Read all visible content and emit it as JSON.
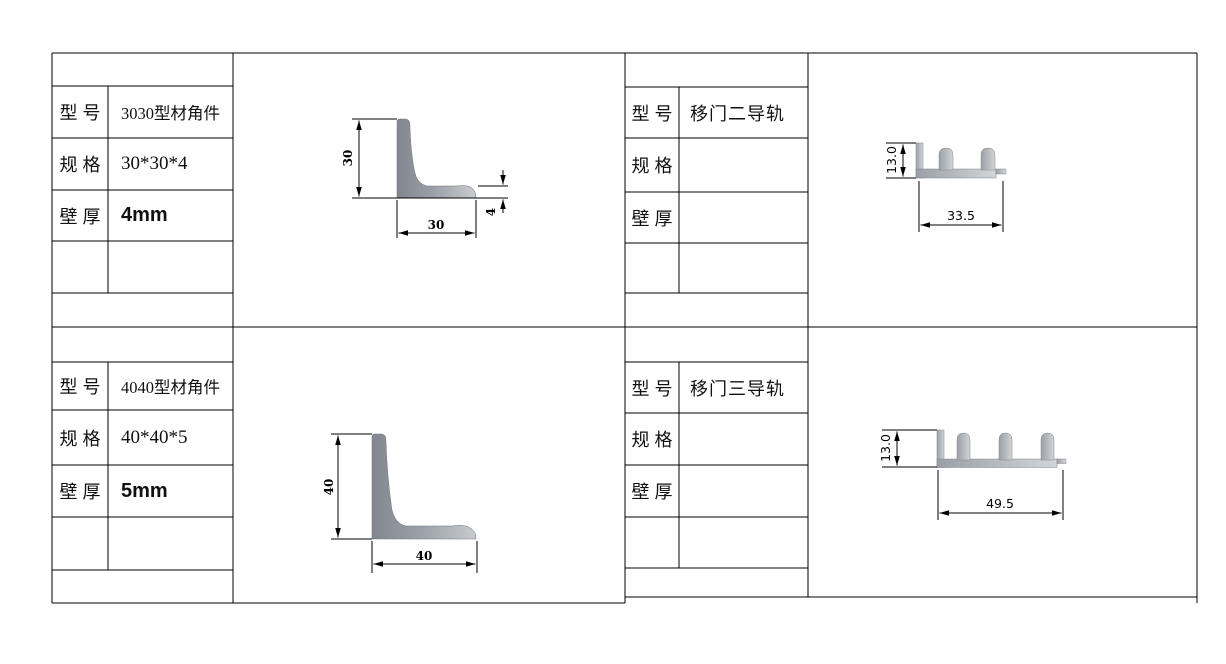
{
  "field_labels": {
    "model": "型号",
    "spec": "规格",
    "wall": "壁厚"
  },
  "panels": {
    "top_left": {
      "model": "3030型材角件",
      "spec": "30*30*4",
      "wall": "4mm",
      "drawing": {
        "shape": "L-angle-profile",
        "height_label": "30",
        "width_label": "30",
        "thickness_label": "4"
      }
    },
    "top_right": {
      "model": "移门二导轨",
      "spec": "",
      "wall": "",
      "drawing": {
        "shape": "two-channel-sliding-door-track-profile",
        "height_label": "13.0",
        "width_label": "33.5"
      }
    },
    "bottom_left": {
      "model": "4040型材角件",
      "spec": "40*40*5",
      "wall": "5mm",
      "drawing": {
        "shape": "L-angle-profile",
        "height_label": "40",
        "width_label": "40"
      }
    },
    "bottom_right": {
      "model": "移门三导轨",
      "spec": "",
      "wall": "",
      "drawing": {
        "shape": "three-channel-sliding-door-track-profile",
        "height_label": "13.0",
        "width_label": "49.5"
      }
    }
  },
  "colors": {
    "background": "#ffffff",
    "grid_line": "#000000",
    "angle_profile_dark": "#82878f",
    "angle_profile_light": "#c8cbce",
    "track_profile_dark": "#9aa0a6",
    "track_profile_light": "#d2d5d8"
  }
}
